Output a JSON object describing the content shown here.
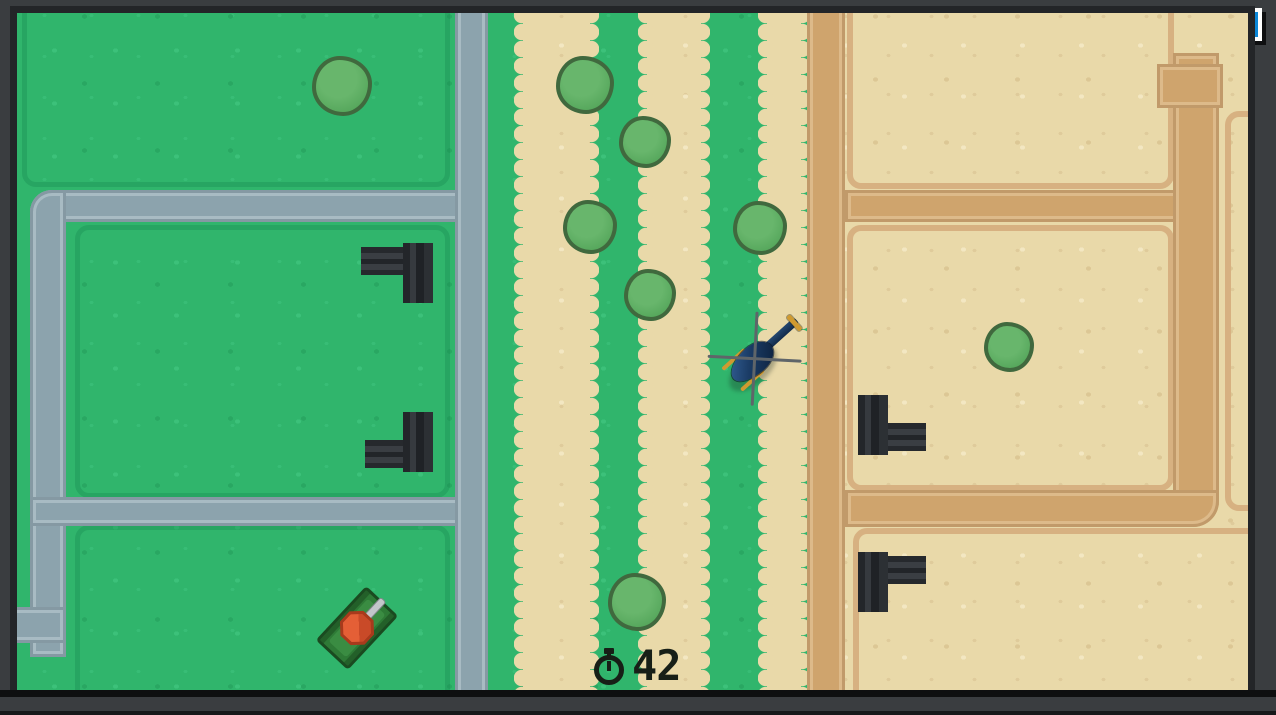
{
  "hud": {
    "player_health": {
      "label": "100 / 100",
      "value": 100,
      "max": 100,
      "color": "#55bb45"
    },
    "enemy_health": {
      "label": "50 / 50",
      "value": 50,
      "max": 50,
      "color": "#0b87d8"
    },
    "timer": {
      "value": "42",
      "icon": "stopwatch-icon"
    }
  },
  "palette": {
    "grass": "#30b56c",
    "sand": "#e9d9a9",
    "gray_road": "#8ca3ad",
    "dirt_road": "#cfa46d",
    "frame": "#3a3d40",
    "turret": "#26292d",
    "tree_fill": "#57a85d",
    "tree_outline": "#40693e",
    "heli_body": "#1b3c66",
    "tank_turret": "#e45f36",
    "timer_color": "#171f17"
  },
  "map": {
    "trees": [
      {
        "x": 325,
        "y": 73,
        "r": 30
      },
      {
        "x": 568,
        "y": 72,
        "r": 29
      },
      {
        "x": 628,
        "y": 129,
        "r": 26
      },
      {
        "x": 573,
        "y": 214,
        "r": 27
      },
      {
        "x": 743,
        "y": 215,
        "r": 27
      },
      {
        "x": 633,
        "y": 282,
        "r": 26
      },
      {
        "x": 620,
        "y": 589,
        "r": 29
      },
      {
        "x": 992,
        "y": 334,
        "r": 25
      }
    ],
    "turrets": [
      {
        "x": 344,
        "y": 230,
        "w": 72,
        "h": 60,
        "variant": "arm-left-top"
      },
      {
        "x": 348,
        "y": 399,
        "w": 68,
        "h": 60,
        "variant": "arm-left-bottom"
      },
      {
        "x": 841,
        "y": 382,
        "w": 68,
        "h": 60,
        "variant": "arm-right-bottom"
      },
      {
        "x": 841,
        "y": 539,
        "w": 68,
        "h": 60,
        "variant": "arm-right-top"
      }
    ],
    "helicopter": {
      "x": 741,
      "y": 342,
      "rotation": -42
    },
    "tank": {
      "x": 340,
      "y": 615,
      "rotation": -47
    }
  }
}
